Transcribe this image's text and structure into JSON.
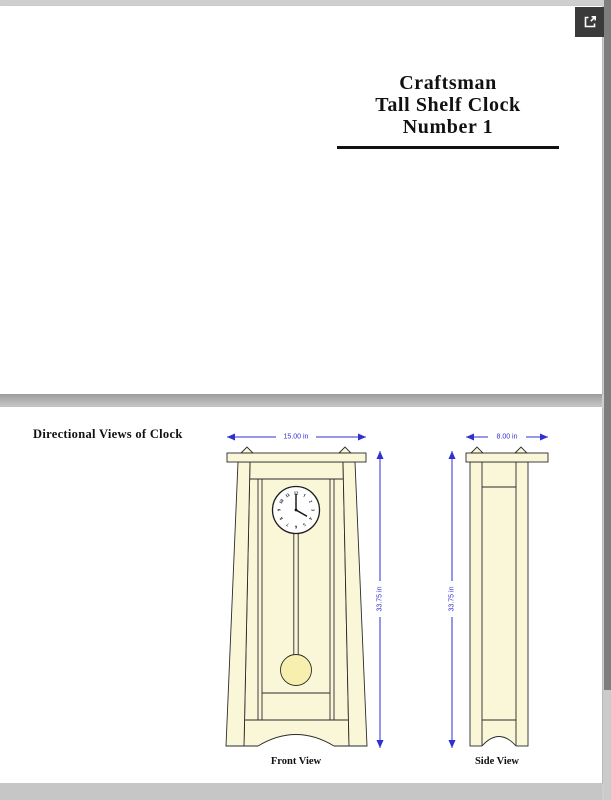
{
  "page1": {
    "title_lines": [
      "Craftsman",
      "Tall Shelf Clock",
      "Number 1"
    ]
  },
  "page2": {
    "heading": "Directional Views of Clock",
    "front_view": {
      "label": "Front View",
      "width_dim": "15.00 in",
      "height_dim": "33.75 in",
      "clock_time": "4:00",
      "clock_numbers": [
        "1",
        "2",
        "3",
        "4",
        "5",
        "6",
        "7",
        "8",
        "9",
        "10",
        "11",
        "12"
      ]
    },
    "side_view": {
      "label": "Side View",
      "width_dim": "8.00 in",
      "height_dim": "33.75 in"
    }
  },
  "viewer": {
    "icons": {
      "open_external": "open-in-new-icon"
    }
  },
  "colors": {
    "dimension_blue": "#2f2fd3",
    "drawing_fill": "#faf6d8",
    "pendulum_bob_fill": "#f6efae",
    "line": "#2b2b2b",
    "button_bg": "#3a3a3a",
    "canvas_bg": "#cfcfcf",
    "page_bg": "#ffffff"
  }
}
